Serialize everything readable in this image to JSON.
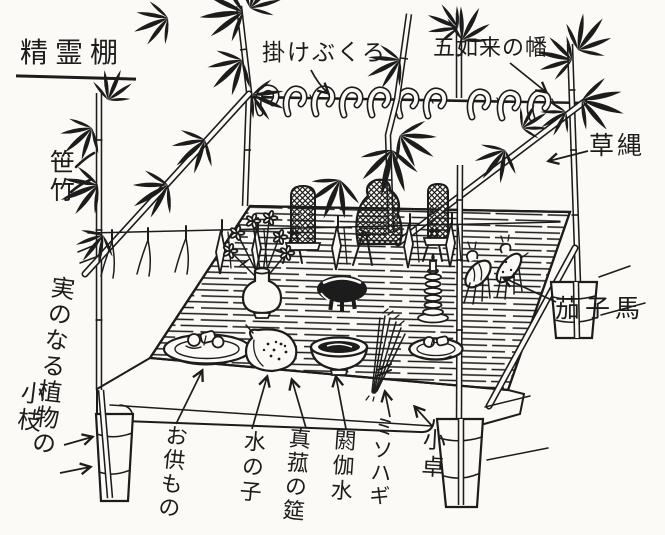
{
  "illustration": {
    "ink_color": "#1c1c1c",
    "paper_color": "#fbfaf6",
    "labels": {
      "title": "精霊棚",
      "hanging_bag": "掛けぶくろ",
      "five_nyorai_banner": "五如来の幡",
      "sasa_bamboo": "笹竹",
      "straw_rope": "草縄",
      "fruiting_branch_line1": "実のなる植物の",
      "fruiting_branch_line2": "小枝",
      "offerings": "お供もの",
      "mizu_no_ko": "水の子",
      "makomo_mat": "真菰の筵",
      "aka_water": "閼伽水",
      "misohagi": "ミソハギ",
      "small_table": "小卓",
      "eggplant_horse": "茄子馬"
    }
  }
}
